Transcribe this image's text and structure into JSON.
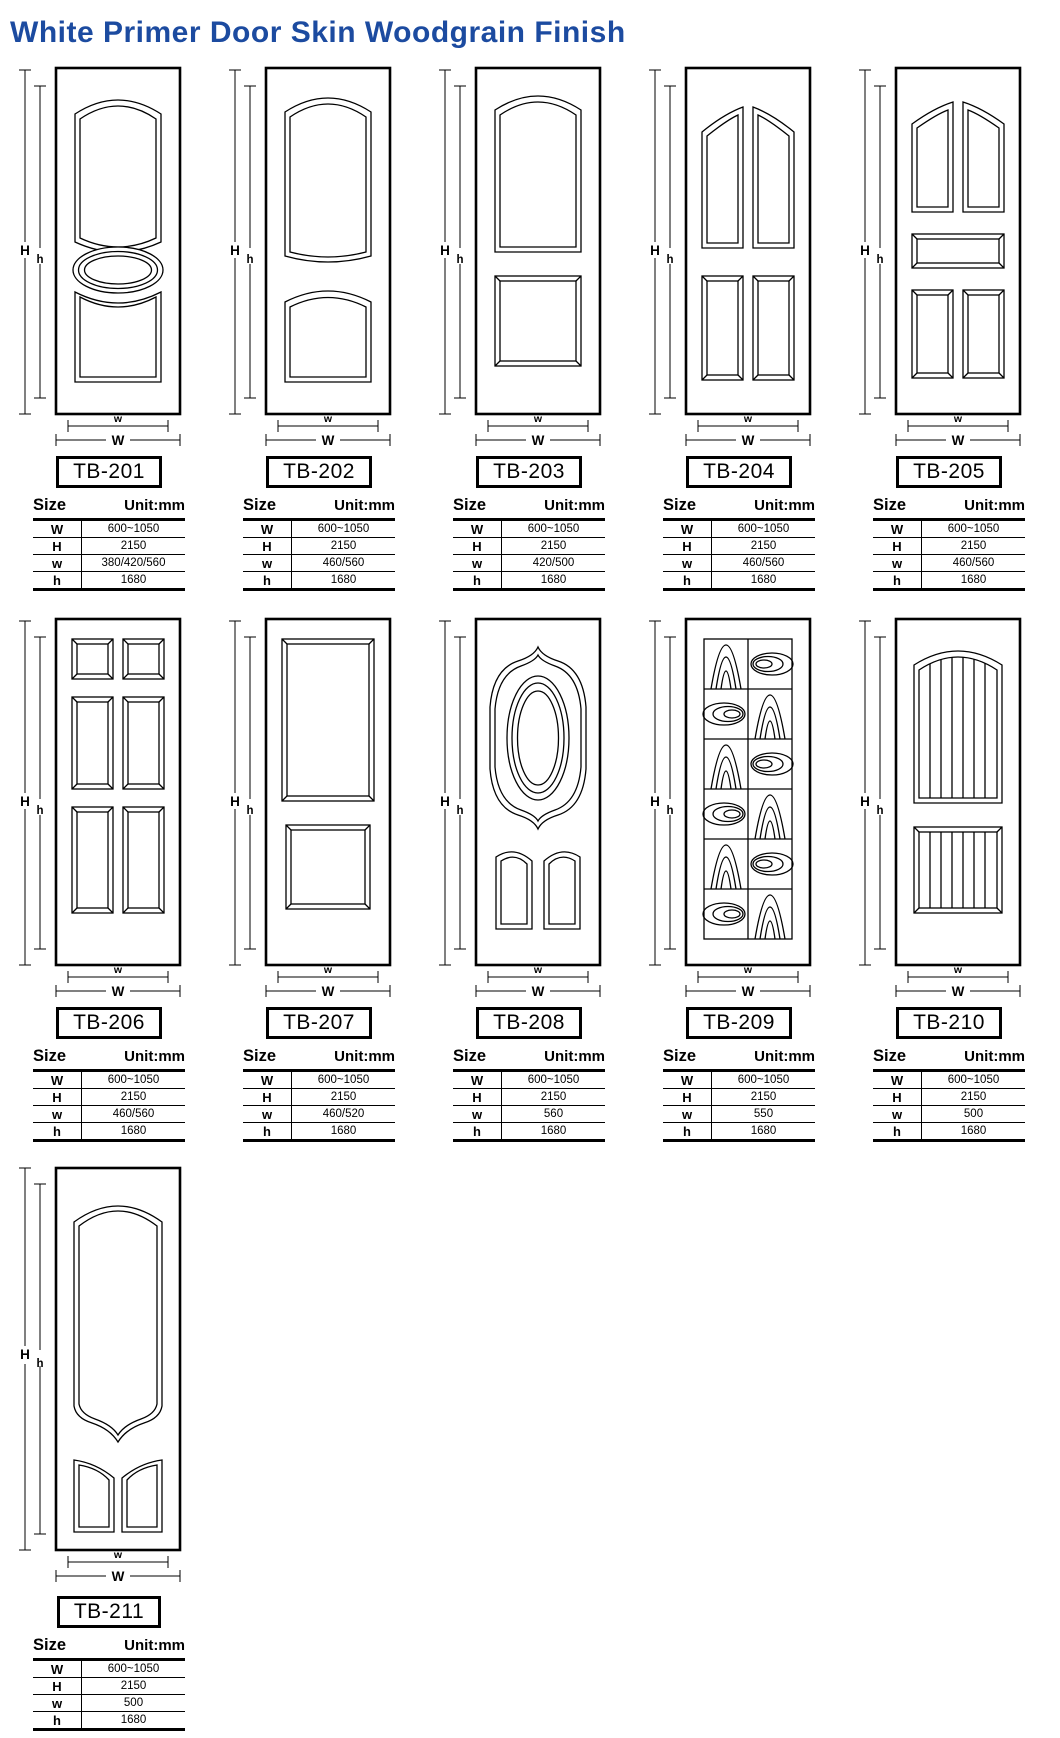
{
  "title": "White Primer Door Skin Woodgrain Finish",
  "colors": {
    "title_blue": "#1c4ba0",
    "line": "#000000"
  },
  "dims": {
    "outer_height": "H",
    "inner_height": "h",
    "outer_width": "W",
    "inner_width": "w"
  },
  "table": {
    "size_label": "Size",
    "unit_label": "Unit:mm",
    "row_labels": [
      "W",
      "H",
      "w",
      "h"
    ]
  },
  "products": [
    {
      "model": "TB-201",
      "design": "arch-top-panel-oval-center-arch-bottom",
      "values": [
        "600~1050",
        "2150",
        "380/420/560",
        "1680"
      ]
    },
    {
      "model": "TB-202",
      "design": "arch-top-panel-arch-bottom-panel",
      "values": [
        "600~1050",
        "2150",
        "460/560",
        "1680"
      ]
    },
    {
      "model": "TB-203",
      "design": "arch-top-panel-square-bottom-panel",
      "values": [
        "600~1050",
        "2150",
        "420/500",
        "1680"
      ]
    },
    {
      "model": "TB-204",
      "design": "four-panel-cathedral-tops",
      "values": [
        "600~1050",
        "2150",
        "460/560",
        "1680"
      ]
    },
    {
      "model": "TB-205",
      "design": "five-panel-cathedral-tops-center-rail",
      "values": [
        "600~1050",
        "2150",
        "460/560",
        "1680"
      ]
    },
    {
      "model": "TB-206",
      "design": "six-panel",
      "values": [
        "600~1050",
        "2150",
        "460/560",
        "1680"
      ]
    },
    {
      "model": "TB-207",
      "design": "two-rectangular-panels",
      "values": [
        "600~1050",
        "2150",
        "460/520",
        "1680"
      ]
    },
    {
      "model": "TB-208",
      "design": "oval-cartouche-two-bottom-panels",
      "values": [
        "600~1050",
        "2150",
        "560",
        "1680"
      ]
    },
    {
      "model": "TB-209",
      "design": "woodgrain-checker-grid",
      "values": [
        "600~1050",
        "2150",
        "550",
        "1680"
      ]
    },
    {
      "model": "TB-210",
      "design": "arch-plank-panels",
      "values": [
        "600~1050",
        "2150",
        "500",
        "1680"
      ]
    },
    {
      "model": "TB-211",
      "design": "arch-bracket-panel-two-slant-panels",
      "values": [
        "600~1050",
        "2150",
        "500",
        "1680"
      ]
    }
  ]
}
